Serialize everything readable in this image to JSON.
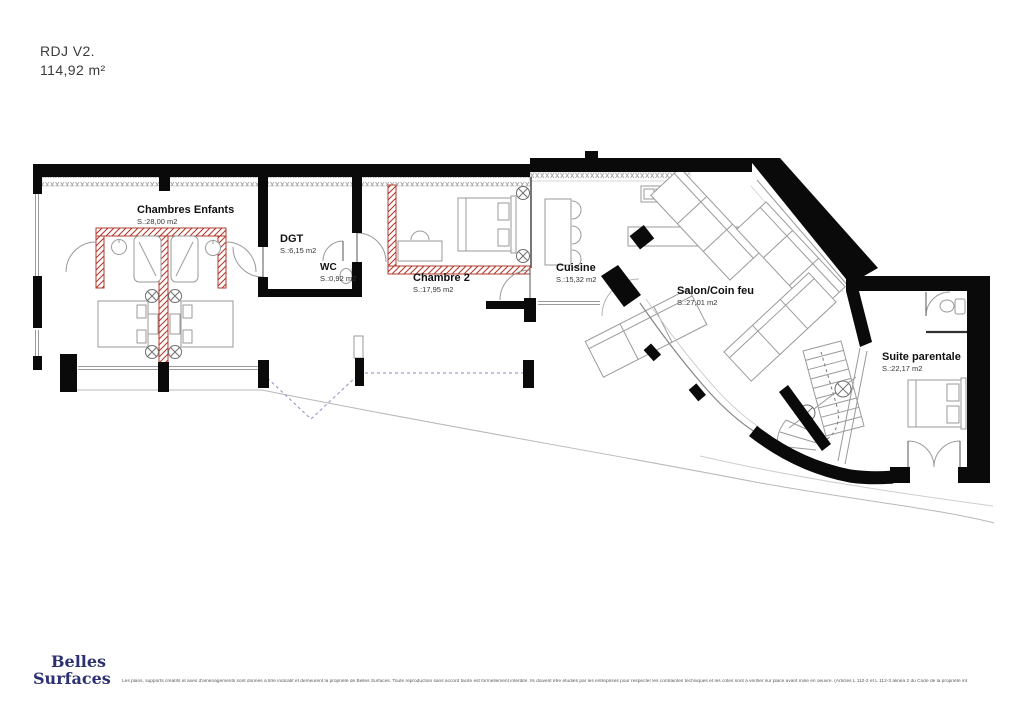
{
  "title": {
    "version": "RDJ V2.",
    "total_area": "114,92 m²"
  },
  "rooms": [
    {
      "name": "Chambres Enfants",
      "area": "S.:28,00 m2"
    },
    {
      "name": "DGT",
      "area": "S.:6,15 m2"
    },
    {
      "name": "WC",
      "area": "S.:0,92 m2"
    },
    {
      "name": "Chambre 2",
      "area": "S.:17,95 m2"
    },
    {
      "name": "Cuisine",
      "area": "S.:15,32 m2"
    },
    {
      "name": "Salon/Coin feu",
      "area": "S.:27,01 m2"
    },
    {
      "name": "Suite parentale",
      "area": "S.:22,17 m2"
    }
  ],
  "logo": {
    "line1": "Belles",
    "line2": "Surfaces"
  },
  "disclaimer": "Les plans, supports créatifs et axes d'aménagements sont donnés à titre indicatif et demeurent la propriété de Belles Surfaces. Toute reproduction sans accord tacite est formellement interdite. Ils doivent être étudiés par les entreprises pour respecter les contraintes techniques et les cotes sont à vérifier sur place avant mise en oeuvre. (Articles L 112-2 et L 112-3 alinéa 2 du Code de la propriété intellectuelle)",
  "colors": {
    "wall": "#0a0a0a",
    "partition_hatch": "#b23b2e",
    "logo": "#2c3172",
    "open_bay_dashed": "#9aa0c8"
  }
}
